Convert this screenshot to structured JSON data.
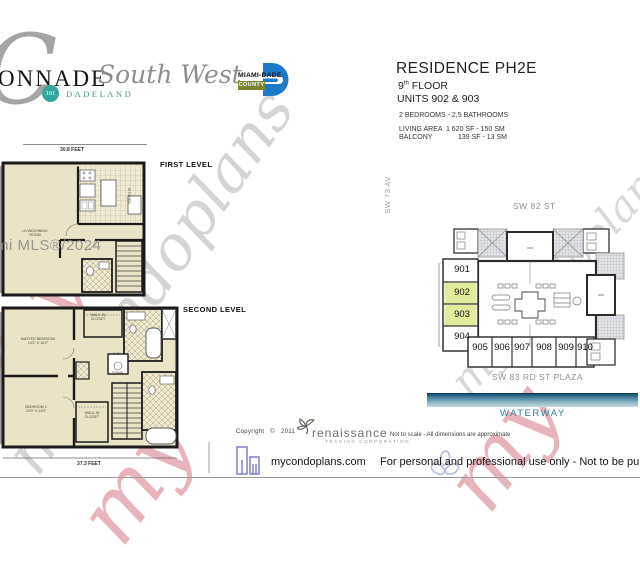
{
  "brand": {
    "big_c": "C",
    "name": "ONNADE",
    "script": "South West",
    "badge_number": "101",
    "badge_name": "DADELAND"
  },
  "county_logo": {
    "line1": "MIAMI-DADE",
    "line2": "COUNTY"
  },
  "residence": {
    "title": "RESIDENCE PH2E",
    "floor_num": "9",
    "floor_sup": "th",
    "floor_word": "FLOOR",
    "units": "UNITS 902 & 903",
    "bed_bath": "2 BEDROOMS - 2,5 BATHROOMS",
    "living_area_label": "LIVING AREA",
    "living_area_value": "1 620 SF - 150 SM",
    "balcony_label": "BALCONY",
    "balcony_value": "139 SF -  13 SM"
  },
  "first_level": {
    "label": "FIRST LEVEL",
    "width_dim": "30.8 FEET",
    "room_living_1": "LIVING/DINING",
    "room_living_2": "ROOM",
    "room_kitchen": "KITCHEN"
  },
  "second_level": {
    "label": "SECOND LEVEL",
    "width_dim": "37.3 FEET",
    "master_1": "MASTER BEDROOM",
    "master_2": "14'2\" X 16'2\"",
    "bedroom2_1": "BEDROOM 2",
    "bedroom2_2": "12'0\" X 14'0\"",
    "walkin_1": "WALK-IN",
    "walkin_2": "CLOSET",
    "down": "DOWN",
    "wd": "W/D"
  },
  "site_plan": {
    "street_left": "SW 73 AV",
    "street_top": "SW 82 ST",
    "street_bottom": "SW 83 RD ST PLAZA",
    "waterway": "WATERWAY",
    "left_units": [
      "901",
      "902",
      "903",
      "904"
    ],
    "bottom_units": [
      "905",
      "906",
      "907",
      "908",
      "909",
      "910"
    ],
    "highlighted_units": "902, 903",
    "highlight_color": "#e2ea9c"
  },
  "watermarks": {
    "script_large": "mycondoplans",
    "script_site": "mycondoplans",
    "script_red": "my",
    "mls": "mi MLS®/2024"
  },
  "footer": {
    "copyright_word": "Copyright",
    "copyright_symbol": "©",
    "copyright_year": "2011",
    "renaissance": "renaissance",
    "renaissance_sub": "TRADING CORPORATION",
    "disclaimer": "Not to scale - All dimensions are approximate",
    "site": "mycondoplans.com",
    "usage": "For personal and professional use only - Not to be published nor repr"
  }
}
